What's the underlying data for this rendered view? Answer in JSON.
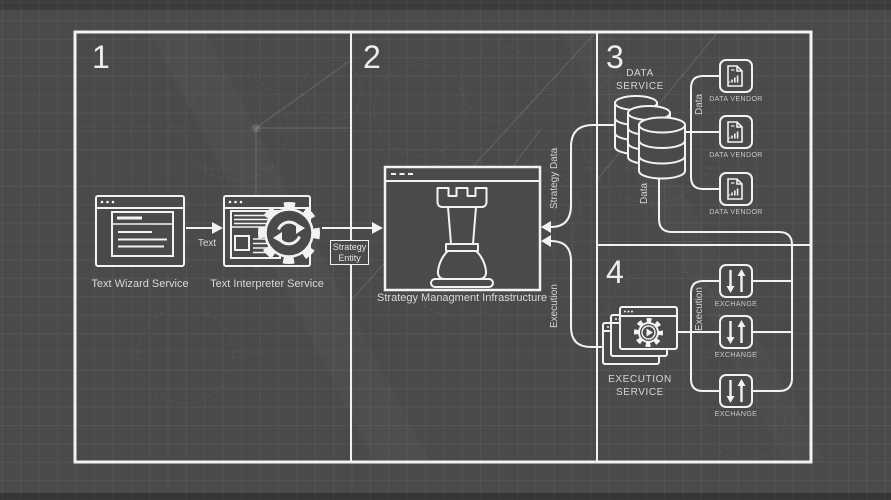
{
  "colors": {
    "background": "#4a4a4a",
    "stroke": "#f2f2f2",
    "text": "#d9d9d9"
  },
  "panels": {
    "one": "1",
    "two": "2",
    "three": "3",
    "four": "4"
  },
  "nodes": {
    "text_wizard": {
      "label": "Text Wizard Service"
    },
    "text_interpreter": {
      "label": "Text Interpreter Service"
    },
    "strategy_management": {
      "label": "Strategy Managment Infrastructure"
    },
    "data_service": {
      "label": "DATA\nSERVICE"
    },
    "execution_service": {
      "label": "EXECUTION\nSERVICE"
    },
    "data_vendors": [
      {
        "label": "DATA VENDOR"
      },
      {
        "label": "DATA VENDOR"
      },
      {
        "label": "DATA VENDOR"
      }
    ],
    "exchanges": [
      {
        "label": "EXCHANGE"
      },
      {
        "label": "EXCHANGE"
      },
      {
        "label": "EXCHANGE"
      }
    ]
  },
  "edges": {
    "text": {
      "label": "Text"
    },
    "strategy_entity": {
      "label": "Strategy\nEntity"
    },
    "strategy_data": {
      "label": "Strategy Data"
    },
    "execution_in": {
      "label": "Execution"
    },
    "data_out": {
      "label": "Data"
    },
    "data_vendor_link": {
      "label": "Data"
    },
    "execution_out": {
      "label": "Execution"
    }
  }
}
